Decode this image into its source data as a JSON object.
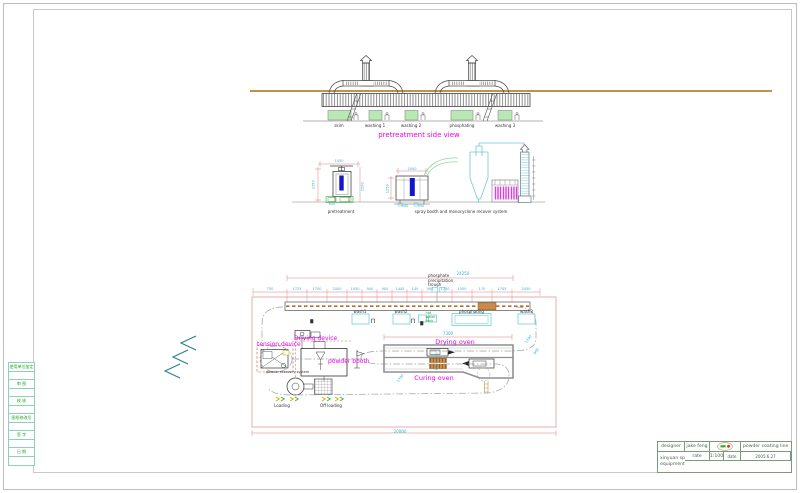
{
  "sheet": {
    "strip_rows": [
      "使用单位鉴定",
      "审 图",
      "校 核",
      "图纸修改号",
      "签 字",
      "日 期"
    ],
    "title_block": {
      "designer_label": "designer",
      "designer": "jake feng",
      "rate_label": "rate",
      "rate": "1:100",
      "date_label": "date",
      "date": "2005.6.27",
      "phone": "T:0086-523-86759666",
      "product": "powder coating line",
      "company_line1": "xinyuan spraying",
      "company_line2": "equipment co;ltd"
    }
  },
  "side_view": {
    "title": "pretreatment side view",
    "tank_labels": [
      "skim",
      "washing 1",
      "washing 2",
      "phosphating",
      "washing 3"
    ]
  },
  "sections": {
    "left_label": "pretreatment",
    "right_label": "spray booth and monocyclone recover system",
    "dims": {
      "left_h": "2350",
      "left_top": "1450",
      "left_r": "2200",
      "left_b": "600",
      "right_top": "2000",
      "right_l": "1250",
      "right_b1": "900",
      "right_b2": "350"
    }
  },
  "plan": {
    "overall_top": "24250",
    "overall_bottom": "20000",
    "oven_span": "7300",
    "seg_dims": [
      "750",
      "1725",
      "1700",
      "2000",
      "1450",
      "900",
      "900",
      "1445",
      "140",
      "900",
      "1700",
      "1500",
      "170",
      "1745",
      "2050"
    ],
    "diag_dim_right1": "1700",
    "diag_dim_right2": "900",
    "diag_dim_left": "1700",
    "side_dim1": "650",
    "side_dim2": "850",
    "trough_lines": [
      "phosphate",
      "precipitation",
      "trough"
    ],
    "hot_water_lines": [
      "hot",
      "water",
      "tank"
    ],
    "tank_labels": [
      "wash1",
      "wash2",
      "phosphating",
      "wash3"
    ],
    "labels": {
      "tension_device": "tension device",
      "driving_device": "Driving device",
      "powder_booth": "powder booth",
      "powder_recovery": "powder recovery system",
      "drying_oven": "Drying oven",
      "curing_oven": "Curing oven",
      "loading": "Loading",
      "off_loading": "Off loading"
    }
  }
}
